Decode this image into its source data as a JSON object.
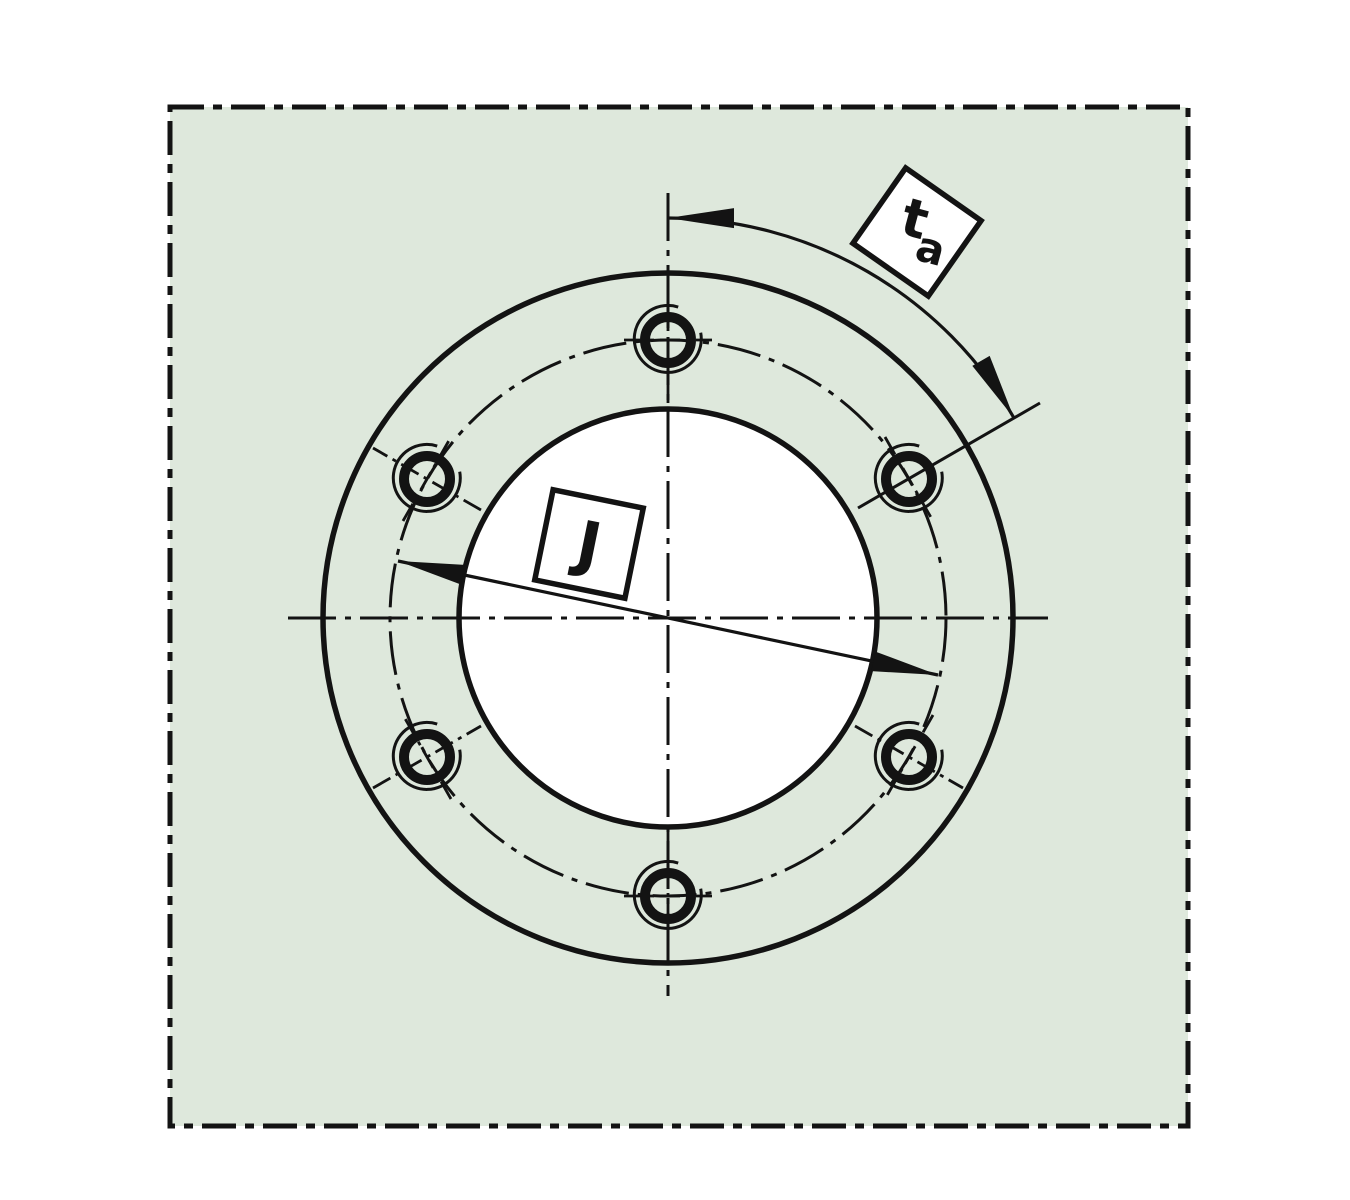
{
  "drawing": {
    "kind": "flange-face-technical-drawing",
    "labels": {
      "angle_main": "t",
      "angle_sub": "a",
      "diameter": "J"
    },
    "colors": {
      "panel_fill": "#dee8dc",
      "line": "#131313",
      "label_box_fill": "#ffffff"
    }
  }
}
